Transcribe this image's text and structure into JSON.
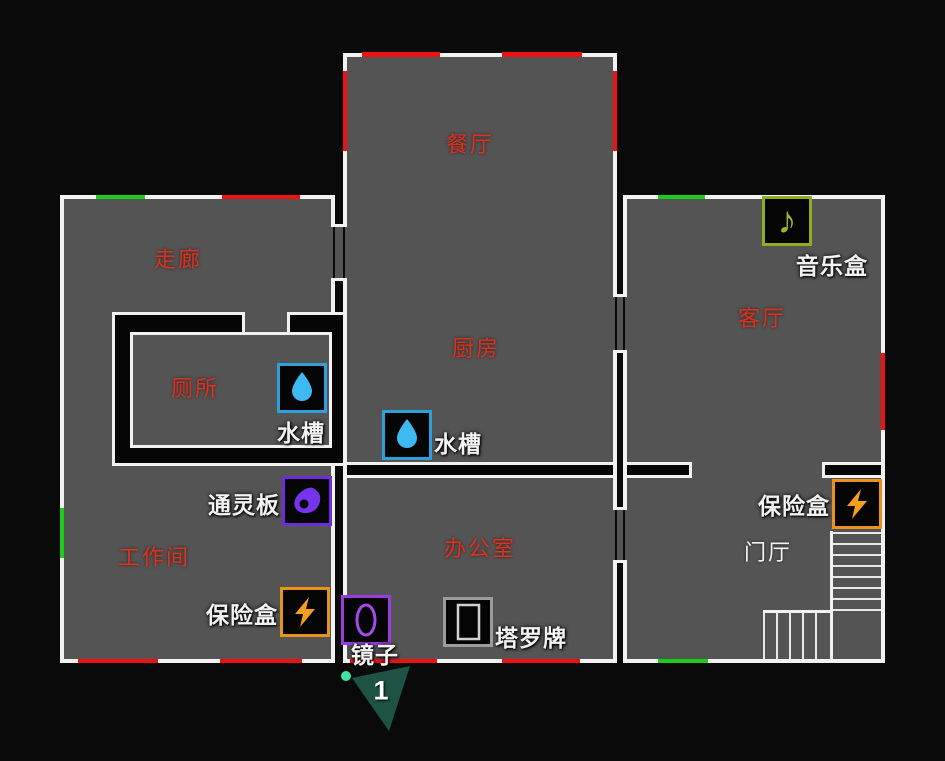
{
  "rooms": {
    "dining": {
      "label": "餐厅"
    },
    "corridor": {
      "label": "走廊"
    },
    "kitchen": {
      "label": "厨房"
    },
    "toilet": {
      "label": "厕所"
    },
    "living_room": {
      "label": "客厅"
    },
    "workshop": {
      "label": "工作间"
    },
    "office": {
      "label": "办公室"
    },
    "foyer": {
      "label": "门厅"
    }
  },
  "items": {
    "music_box": {
      "label": "音乐盒",
      "type": "music-box",
      "room": "living_room"
    },
    "sink_toilet": {
      "label": "水槽",
      "type": "sink",
      "room": "toilet"
    },
    "sink_kitchen": {
      "label": "水槽",
      "type": "sink",
      "room": "kitchen"
    },
    "ouija_board": {
      "label": "通灵板",
      "type": "ouija-board",
      "room": "workshop"
    },
    "fuse_box_workshop": {
      "label": "保险盒",
      "type": "fuse-box",
      "room": "workshop"
    },
    "fuse_box_foyer": {
      "label": "保险盒",
      "type": "fuse-box",
      "room": "foyer"
    },
    "mirror": {
      "label": "镜子",
      "type": "mirror",
      "room": "office"
    },
    "tarot_cards": {
      "label": "塔罗牌",
      "type": "tarot-cards",
      "room": "office"
    }
  },
  "player": {
    "number": "1"
  },
  "map_features": {
    "windows_red_count": 10,
    "exit_doors_green_count": 4,
    "stairs": "foyer L-shaped staircase"
  },
  "colors": {
    "background": "#0a0a0a",
    "floor": "#545454",
    "wall": "#f2f2f2",
    "window": "#ed1111",
    "exit_door": "#1ccc1c",
    "room_label": "#e1301d",
    "foyer_label": "#f2f2f2",
    "item_label": "#f2f2f2",
    "water_accent": "#2da0dc",
    "electric_accent": "#e9921c",
    "cursed_accent": "#6e2dd8",
    "mirror_accent": "#9a3be0",
    "music_accent": "#90ad20",
    "tarot_accent": "#9c9c9c",
    "player_marker": "#1d5244",
    "player_dot": "#41e3a3"
  }
}
